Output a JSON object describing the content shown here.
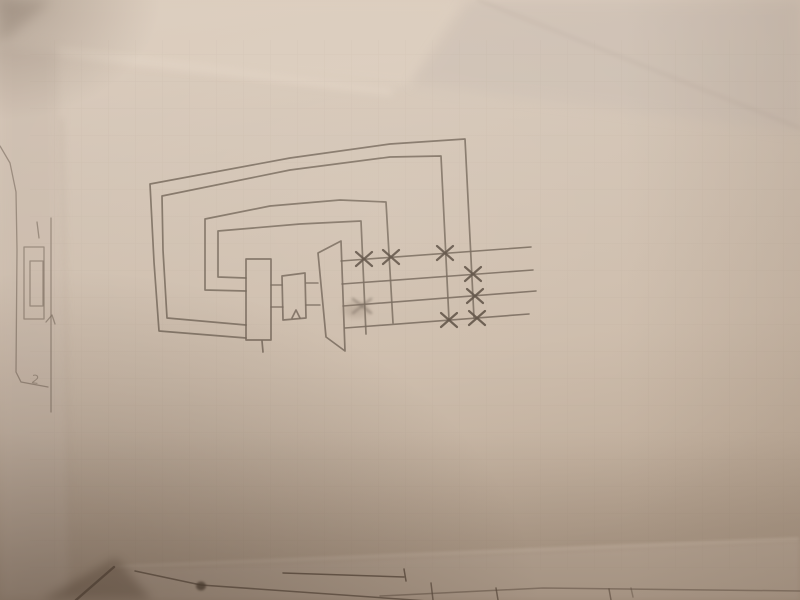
{
  "scene": {
    "description": "Photograph of a pencil hand-drawn thermal-cycle schematic (boiler, drum and turbine with extraction lines and X valve marks, wrapped by nested piping loops) on a sheet of paper overlapping other sketched sheets",
    "colors": {
      "pencil": "#6d5f52",
      "pencil_dark": "#57493d",
      "fold_light": "#dccdbe",
      "top_right_sheet": "#c9bcb1",
      "left_sheet": "#c9b9ab",
      "under_sheet": "#c2b1a1",
      "corner_shadow": "#5f4d3e",
      "paper_top": "#dbccbd",
      "paper_mid": "#d2c3b4",
      "paper_low": "#c5b4a3",
      "paper_bottom": "#b3a18f"
    }
  },
  "photo_layers": [
    {
      "name": "top-fold-sheet",
      "type": "polygon",
      "points": [
        [
          0,
          0
        ],
        [
          462,
          0
        ],
        [
          408,
          86
        ],
        [
          0,
          52
        ]
      ],
      "fill": "fold_light",
      "op": 0.7,
      "blur": 5
    },
    {
      "name": "top-fold-highlight",
      "type": "line",
      "points": [
        [
          0,
          44
        ],
        [
          390,
          92
        ]
      ],
      "color": "#e8dacb",
      "w": 6,
      "op": 0.5,
      "blur": 4
    },
    {
      "name": "top-right-sheet-corner",
      "type": "polygon",
      "points": [
        [
          470,
          0
        ],
        [
          800,
          0
        ],
        [
          800,
          132
        ],
        [
          412,
          84
        ]
      ],
      "fill": "top_right_sheet",
      "op": 0.55,
      "blur": 6
    },
    {
      "name": "top-right-sheet-edge",
      "type": "line",
      "points": [
        [
          478,
          0
        ],
        [
          800,
          128
        ]
      ],
      "color": "#b3a296",
      "w": 2,
      "op": 0.4,
      "blur": 2
    },
    {
      "name": "top-left-corner-shade",
      "type": "polygon",
      "points": [
        [
          0,
          0
        ],
        [
          52,
          0
        ],
        [
          0,
          44
        ]
      ],
      "fill": "#b0a092",
      "op": 0.55,
      "blur": 6
    },
    {
      "name": "left-sheet-region",
      "type": "polygon",
      "points": [
        [
          0,
          40
        ],
        [
          58,
          46
        ],
        [
          70,
          600
        ],
        [
          0,
          600
        ]
      ],
      "fill": "left_sheet",
      "op": 0.5,
      "blur": 5
    },
    {
      "name": "main-sheet-left-edge",
      "type": "line",
      "points": [
        [
          62,
          120
        ],
        [
          72,
          600
        ]
      ],
      "color": "#ab9a89",
      "w": 2,
      "op": 0.3,
      "blur": 3
    },
    {
      "name": "under-sheet-region",
      "type": "polygon",
      "points": [
        [
          108,
          570
        ],
        [
          800,
          540
        ],
        [
          800,
          600
        ],
        [
          60,
          600
        ]
      ],
      "fill": "under_sheet",
      "op": 0.75,
      "blur": 3
    },
    {
      "name": "under-sheet-edge-highlight",
      "type": "line",
      "points": [
        [
          110,
          567
        ],
        [
          798,
          539
        ]
      ],
      "color": "#e6d7c7",
      "w": 2,
      "op": 0.5,
      "blur": 1.5
    },
    {
      "name": "bottom-left-corner-shadow",
      "type": "polygon",
      "points": [
        [
          42,
          600
        ],
        [
          116,
          558
        ],
        [
          152,
          600
        ]
      ],
      "fill": "corner_shadow",
      "op": 0.45,
      "blur": 5
    }
  ],
  "diagram": {
    "loops": [
      {
        "name": "piping-loop-outer-1",
        "points": [
          [
            246,
            338
          ],
          [
            159,
            331
          ],
          [
            154,
            262
          ],
          [
            150,
            184
          ],
          [
            290,
            158
          ],
          [
            390,
            144
          ],
          [
            465,
            139
          ],
          [
            474,
            318
          ]
        ]
      },
      {
        "name": "piping-loop-outer-2",
        "points": [
          [
            246,
            325
          ],
          [
            167,
            318
          ],
          [
            163,
            250
          ],
          [
            162,
            196
          ],
          [
            290,
            170
          ],
          [
            390,
            157
          ],
          [
            441,
            156
          ],
          [
            449,
            320
          ]
        ]
      },
      {
        "name": "piping-loop-inner-3",
        "points": [
          [
            246,
            291
          ],
          [
            205,
            290
          ],
          [
            205,
            219
          ],
          [
            270,
            206
          ],
          [
            340,
            200
          ],
          [
            386,
            202
          ],
          [
            393,
            323
          ]
        ]
      },
      {
        "name": "piping-loop-inner-4",
        "points": [
          [
            246,
            278
          ],
          [
            218,
            277
          ],
          [
            218,
            231
          ],
          [
            300,
            224
          ],
          [
            361,
            221
          ],
          [
            366,
            334
          ]
        ]
      }
    ],
    "components": [
      {
        "name": "boiler-rectangle",
        "type": "polygon",
        "points": [
          [
            246,
            259
          ],
          [
            271,
            259
          ],
          [
            271,
            340
          ],
          [
            246,
            340
          ]
        ]
      },
      {
        "name": "boiler-drain-tick",
        "type": "line",
        "points": [
          [
            262,
            341
          ],
          [
            263,
            352
          ]
        ]
      },
      {
        "name": "drum-rectangle",
        "type": "polygon",
        "points": [
          [
            282,
            276
          ],
          [
            305,
            273
          ],
          [
            306,
            318
          ],
          [
            283,
            320
          ]
        ]
      },
      {
        "name": "drum-caret-mark",
        "type": "polyline",
        "points": [
          [
            292,
            318
          ],
          [
            296,
            310
          ],
          [
            300,
            318
          ]
        ]
      },
      {
        "name": "turbine-trapezoid",
        "type": "polygon",
        "points": [
          [
            318,
            253
          ],
          [
            341,
            241
          ],
          [
            345,
            351
          ],
          [
            326,
            337
          ]
        ]
      }
    ],
    "connectors": [
      {
        "name": "boiler-to-drum-upper-pipe",
        "type": "line",
        "points": [
          [
            271,
            285
          ],
          [
            282,
            285
          ]
        ]
      },
      {
        "name": "boiler-to-drum-lower-pipe",
        "type": "line",
        "points": [
          [
            271,
            307
          ],
          [
            283,
            307
          ]
        ]
      },
      {
        "name": "drum-to-turbine-upper-pipe",
        "type": "line",
        "points": [
          [
            306,
            283
          ],
          [
            318,
            283
          ]
        ]
      },
      {
        "name": "drum-to-turbine-lower-pipe",
        "type": "line",
        "points": [
          [
            306,
            305
          ],
          [
            320,
            305
          ]
        ]
      }
    ],
    "extraction_lines": [
      {
        "name": "extraction-line-1",
        "type": "line",
        "points": [
          [
            341,
            261
          ],
          [
            531,
            247
          ]
        ]
      },
      {
        "name": "extraction-line-2",
        "type": "line",
        "points": [
          [
            342,
            284
          ],
          [
            533,
            270
          ]
        ]
      },
      {
        "name": "extraction-line-3",
        "type": "line",
        "points": [
          [
            343,
            306
          ],
          [
            536,
            291
          ]
        ]
      },
      {
        "name": "extraction-line-4",
        "type": "line",
        "points": [
          [
            345,
            328
          ],
          [
            529,
            314
          ]
        ]
      }
    ],
    "valves": [
      {
        "name": "valve-x-line1-a",
        "x": 364,
        "y": 259
      },
      {
        "name": "valve-x-line1-b",
        "x": 391,
        "y": 257
      },
      {
        "name": "valve-x-line1-c",
        "x": 445,
        "y": 253
      },
      {
        "name": "valve-x-line2-a",
        "x": 473,
        "y": 274
      },
      {
        "name": "valve-x-line3-a",
        "x": 475,
        "y": 296
      },
      {
        "name": "valve-x-line4-a",
        "x": 449,
        "y": 320
      },
      {
        "name": "valve-x-line4-b",
        "x": 477,
        "y": 318
      }
    ],
    "smudge": {
      "name": "erased-valve-smudge",
      "x": 362,
      "y": 306
    }
  },
  "left_sheet_drawing": {
    "fragments": [
      {
        "name": "left-sheet-curve",
        "type": "polyline",
        "points": [
          [
            0,
            146
          ],
          [
            10,
            163
          ],
          [
            16,
            192
          ],
          [
            17,
            250
          ],
          [
            16,
            372
          ],
          [
            21,
            382
          ],
          [
            48,
            387
          ]
        ]
      },
      {
        "name": "left-sheet-vertical-line",
        "type": "line",
        "points": [
          [
            51,
            218
          ],
          [
            51,
            412
          ]
        ]
      },
      {
        "name": "left-sheet-arrowhead",
        "type": "polyline",
        "points": [
          [
            46,
            322
          ],
          [
            52,
            315
          ],
          [
            55,
            324
          ]
        ]
      },
      {
        "name": "left-sheet-outer-rect",
        "type": "polygon",
        "points": [
          [
            24,
            247
          ],
          [
            44,
            247
          ],
          [
            44,
            319
          ],
          [
            24,
            319
          ]
        ]
      },
      {
        "name": "left-sheet-inner-rect",
        "type": "polygon",
        "points": [
          [
            30,
            261
          ],
          [
            43,
            261
          ],
          [
            43,
            306
          ],
          [
            30,
            306
          ]
        ]
      },
      {
        "name": "left-sheet-tick",
        "type": "line",
        "points": [
          [
            37,
            222
          ],
          [
            39,
            238
          ]
        ]
      },
      {
        "name": "left-sheet-faint-digit",
        "type": "text",
        "x": 31,
        "y": 383,
        "size": 12,
        "rotate": 8,
        "op": 0.5
      }
    ],
    "faint_digit": "2"
  },
  "bottom_sheet_drawing": {
    "fragments": [
      {
        "name": "bottom-corner-edge",
        "type": "line",
        "points": [
          [
            76,
            600
          ],
          [
            114,
            567
          ]
        ],
        "w": 2.4,
        "color": "pencil_dark",
        "op": 0.8
      },
      {
        "name": "bottom-long-diagonal",
        "type": "polyline",
        "points": [
          [
            135,
            571
          ],
          [
            201,
            585
          ],
          [
            470,
            604
          ]
        ],
        "op": 0.75
      },
      {
        "name": "bottom-shallow-line",
        "type": "line",
        "points": [
          [
            283,
            573
          ],
          [
            404,
            577
          ]
        ],
        "op": 0.8
      },
      {
        "name": "bottom-line-end-tick",
        "type": "line",
        "points": [
          [
            404,
            569
          ],
          [
            406,
            581
          ]
        ],
        "op": 0.8
      },
      {
        "name": "bottom-far-line",
        "type": "polyline",
        "points": [
          [
            380,
            596
          ],
          [
            543,
            588
          ],
          [
            800,
            591
          ]
        ],
        "op": 0.5
      },
      {
        "name": "bottom-tick-1",
        "type": "line",
        "points": [
          [
            431,
            583
          ],
          [
            433,
            600
          ]
        ],
        "op": 0.7
      },
      {
        "name": "bottom-tick-2",
        "type": "line",
        "points": [
          [
            496,
            588
          ],
          [
            498,
            600
          ]
        ],
        "op": 0.7
      },
      {
        "name": "bottom-tick-3",
        "type": "line",
        "points": [
          [
            609,
            589
          ],
          [
            611,
            600
          ]
        ],
        "op": 0.6
      },
      {
        "name": "bottom-tick-4",
        "type": "line",
        "points": [
          [
            631,
            588
          ],
          [
            633,
            597
          ]
        ],
        "op": 0.4
      },
      {
        "name": "bottom-ink-blob",
        "type": "ellipse",
        "cx": 201,
        "cy": 586,
        "rx": 5,
        "ry": 4.5,
        "fill": "#4a3d33",
        "op": 0.8,
        "blur": 1
      }
    ]
  }
}
